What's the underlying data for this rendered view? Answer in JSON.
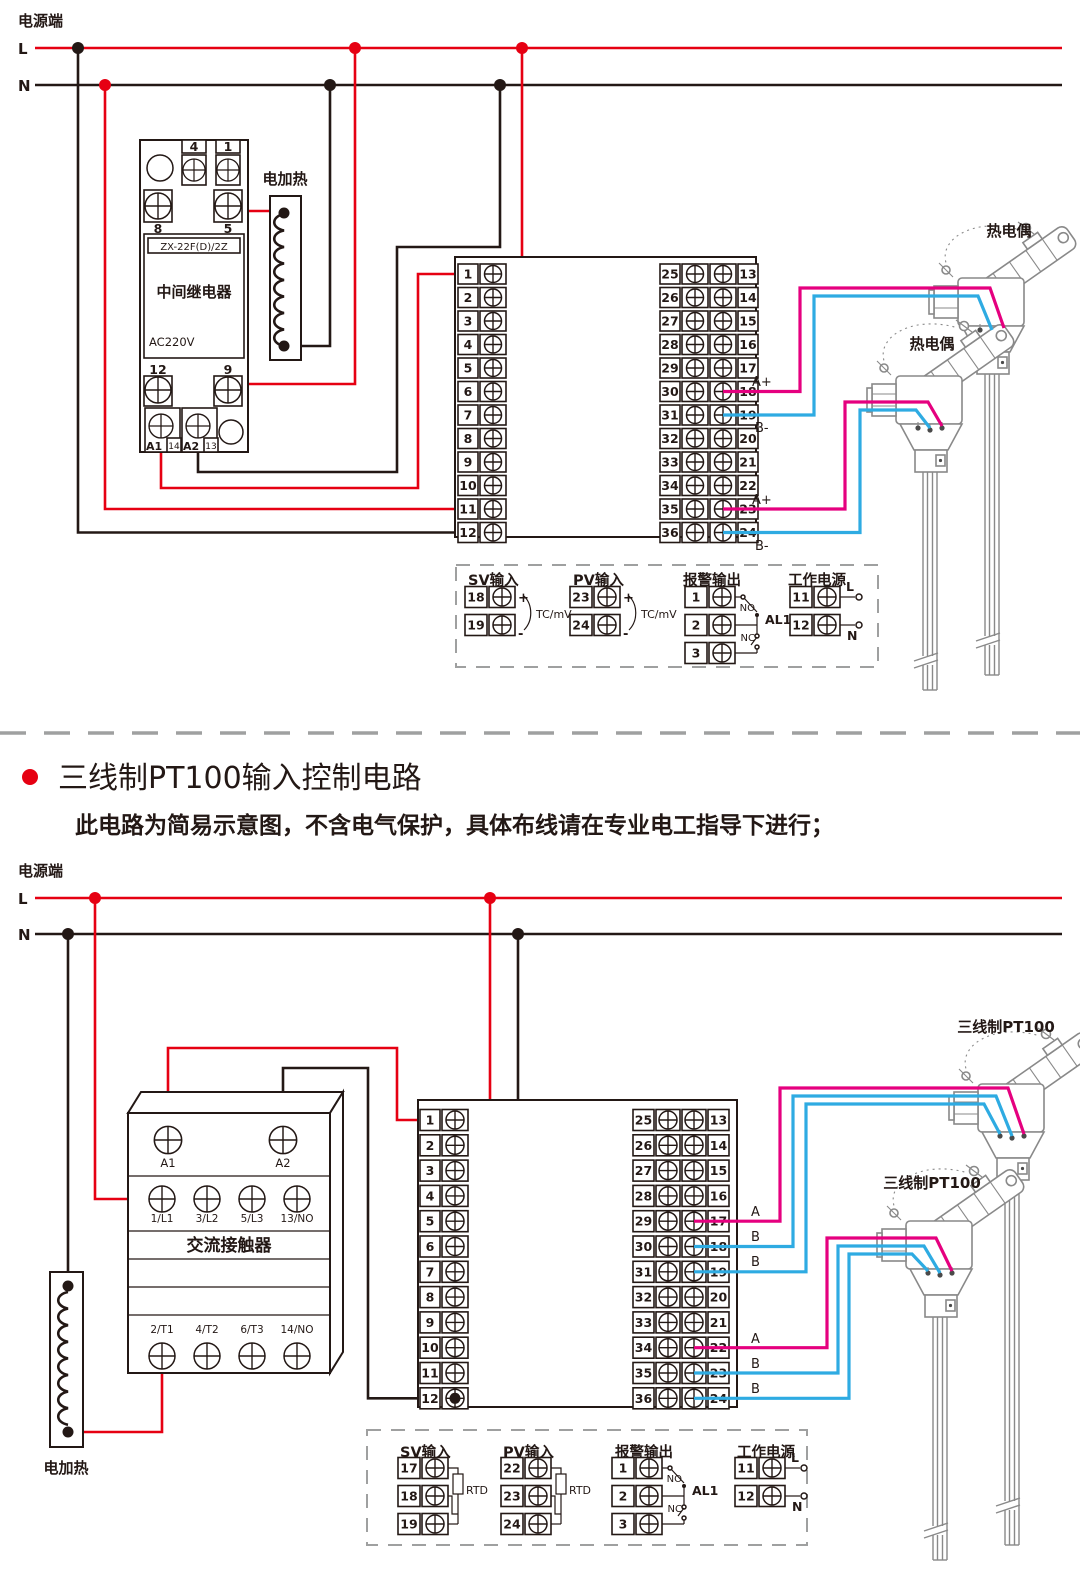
{
  "colors": {
    "line_red": "#e60012",
    "wire_pink": "#e5007f",
    "wire_blue": "#2eabe2",
    "ink": "#231815",
    "divider": "#9fa0a0"
  },
  "terminals": {
    "col_1_12": [
      "1",
      "2",
      "3",
      "4",
      "5",
      "6",
      "7",
      "8",
      "9",
      "10",
      "11",
      "12"
    ],
    "col_25_36": [
      "25",
      "26",
      "27",
      "28",
      "29",
      "30",
      "31",
      "32",
      "33",
      "34",
      "35",
      "36"
    ],
    "col_13_24": [
      "13",
      "14",
      "15",
      "16",
      "17",
      "18",
      "19",
      "20",
      "21",
      "22",
      "23",
      "24"
    ]
  },
  "top": {
    "power_label": "电源端",
    "l": "L",
    "n": "N",
    "relay": {
      "t_top": [
        "4",
        "1"
      ],
      "t_row2": [
        "8",
        "5"
      ],
      "model": "ZX-22F(D)/2Z",
      "name": "中间继电器",
      "voltage": "AC220V",
      "t_row3": [
        "12",
        "9"
      ],
      "a1": "A1",
      "n14": "14",
      "a2": "A2",
      "n13": "13"
    },
    "heater": "电加热",
    "sensor1": "热电偶",
    "sensor2": "热电偶",
    "labels": {
      "w18": "A+",
      "w19": "B-",
      "w23": "A+",
      "w24": "B-"
    },
    "legend": {
      "sv": {
        "title": "SV输入",
        "nums": [
          "18",
          "19"
        ],
        "plus": "+",
        "minus": "-",
        "type": "TC/mV"
      },
      "pv": {
        "title": "PV输入",
        "nums": [
          "23",
          "24"
        ],
        "plus": "+",
        "minus": "-",
        "type": "TC/mV"
      },
      "alarm": {
        "title": "报警输出",
        "nums": [
          "1",
          "2",
          "3"
        ],
        "no": "NO",
        "nc": "NC",
        "name": "AL1"
      },
      "power": {
        "title": "工作电源",
        "nums": [
          "11",
          "12"
        ],
        "l": "L",
        "n": "N"
      }
    }
  },
  "middle": {
    "title": "三线制PT100输入控制电路",
    "subtitle": "此电路为简易示意图，不含电气保护，具体布线请在专业电工指导下进行；"
  },
  "bottom": {
    "power_label": "电源端",
    "l": "L",
    "n": "N",
    "contactor": {
      "a1": "A1",
      "a2": "A2",
      "row_top": [
        "1/L1",
        "3/L2",
        "5/L3",
        "13/NO"
      ],
      "name": "交流接触器",
      "row_bottom": [
        "2/T1",
        "4/T2",
        "6/T3",
        "14/NO"
      ]
    },
    "heater": "电加热",
    "sensor1": "三线制PT100",
    "sensor2": "三线制PT100",
    "labels": {
      "w17": "A",
      "w18": "B",
      "w19": "B",
      "w22": "A",
      "w23": "B",
      "w24": "B"
    },
    "legend": {
      "sv": {
        "title": "SV输入",
        "nums": [
          "17",
          "18",
          "19"
        ],
        "type": "RTD"
      },
      "pv": {
        "title": "PV输入",
        "nums": [
          "22",
          "23",
          "24"
        ],
        "type": "RTD"
      },
      "alarm": {
        "title": "报警输出",
        "nums": [
          "1",
          "2",
          "3"
        ],
        "no": "NO",
        "nc": "NC",
        "name": "AL1"
      },
      "power": {
        "title": "工作电源",
        "nums": [
          "11",
          "12"
        ],
        "l": "L",
        "n": "N"
      }
    }
  }
}
